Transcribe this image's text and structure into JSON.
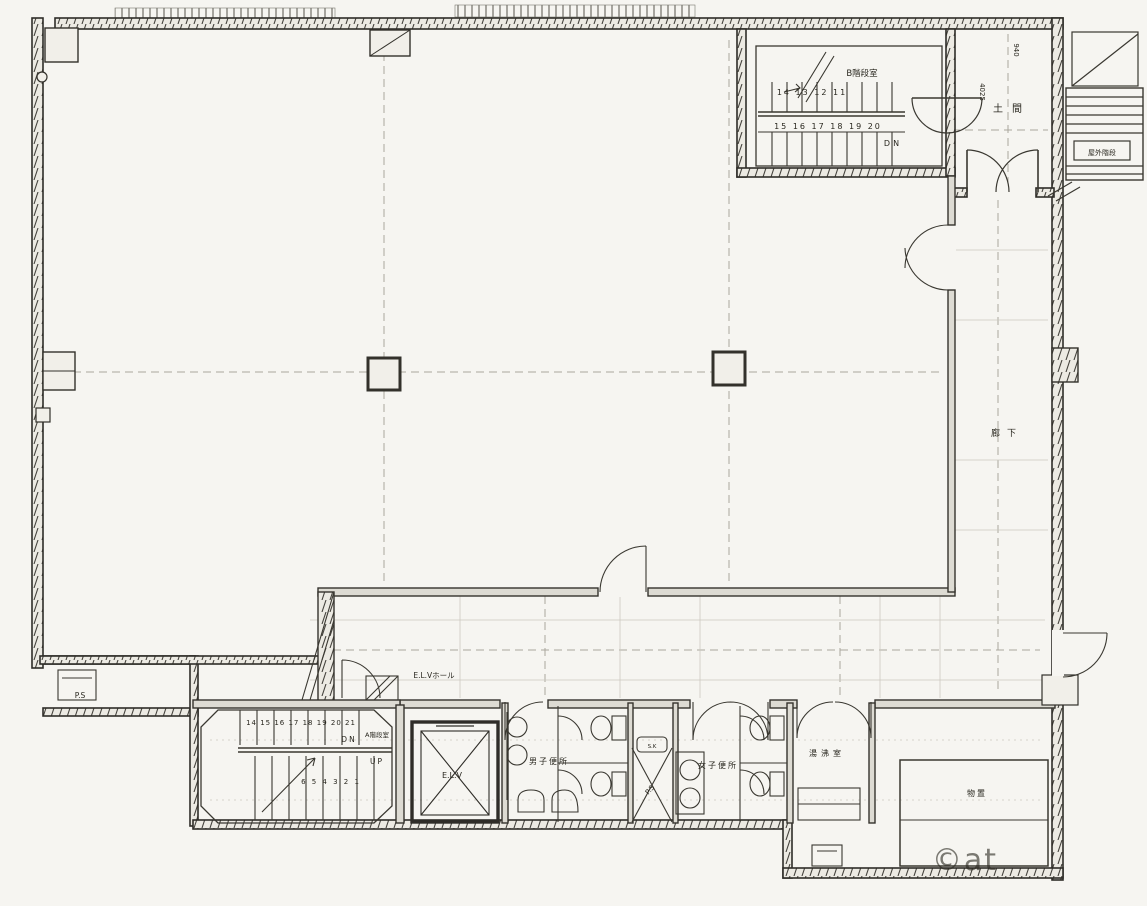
{
  "plan": {
    "labels": {
      "stair_b_name": "B階段室",
      "stair_b_numbers_top": "14 13 12 11",
      "stair_b_numbers_bottom": "15 16 17 18 19 20",
      "stair_b_dn": "DN",
      "entrance_name": "土間",
      "dim_940": "940",
      "dim_4025": "4025",
      "outdoor_stair": "屋外階段",
      "corridor": "廊下",
      "elv_hall": "E.L.Vホール",
      "elevator": "E.L.V",
      "stair_a_name": "A階段室",
      "stair_a_numbers_top": "14 15 16 17 18 19 20 21",
      "stair_a_numbers_bottom": "6 5 4 3 2 1",
      "stair_a_dn": "DN",
      "stair_a_up": "UP",
      "pipe_space_left": "P.S",
      "pipe_space_center": "P.S",
      "slop_sink": "S.K",
      "mens_toilet": "男子便所",
      "womens_toilet": "女子便所",
      "kitchenette": "湯沸室",
      "storage": "物置",
      "watermark": "©at"
    },
    "colors": {
      "paper": "#f6f5f1",
      "ink": "#2f2d28",
      "faint_line": "#aaa79d",
      "watermark": "#d8d6cf"
    }
  }
}
